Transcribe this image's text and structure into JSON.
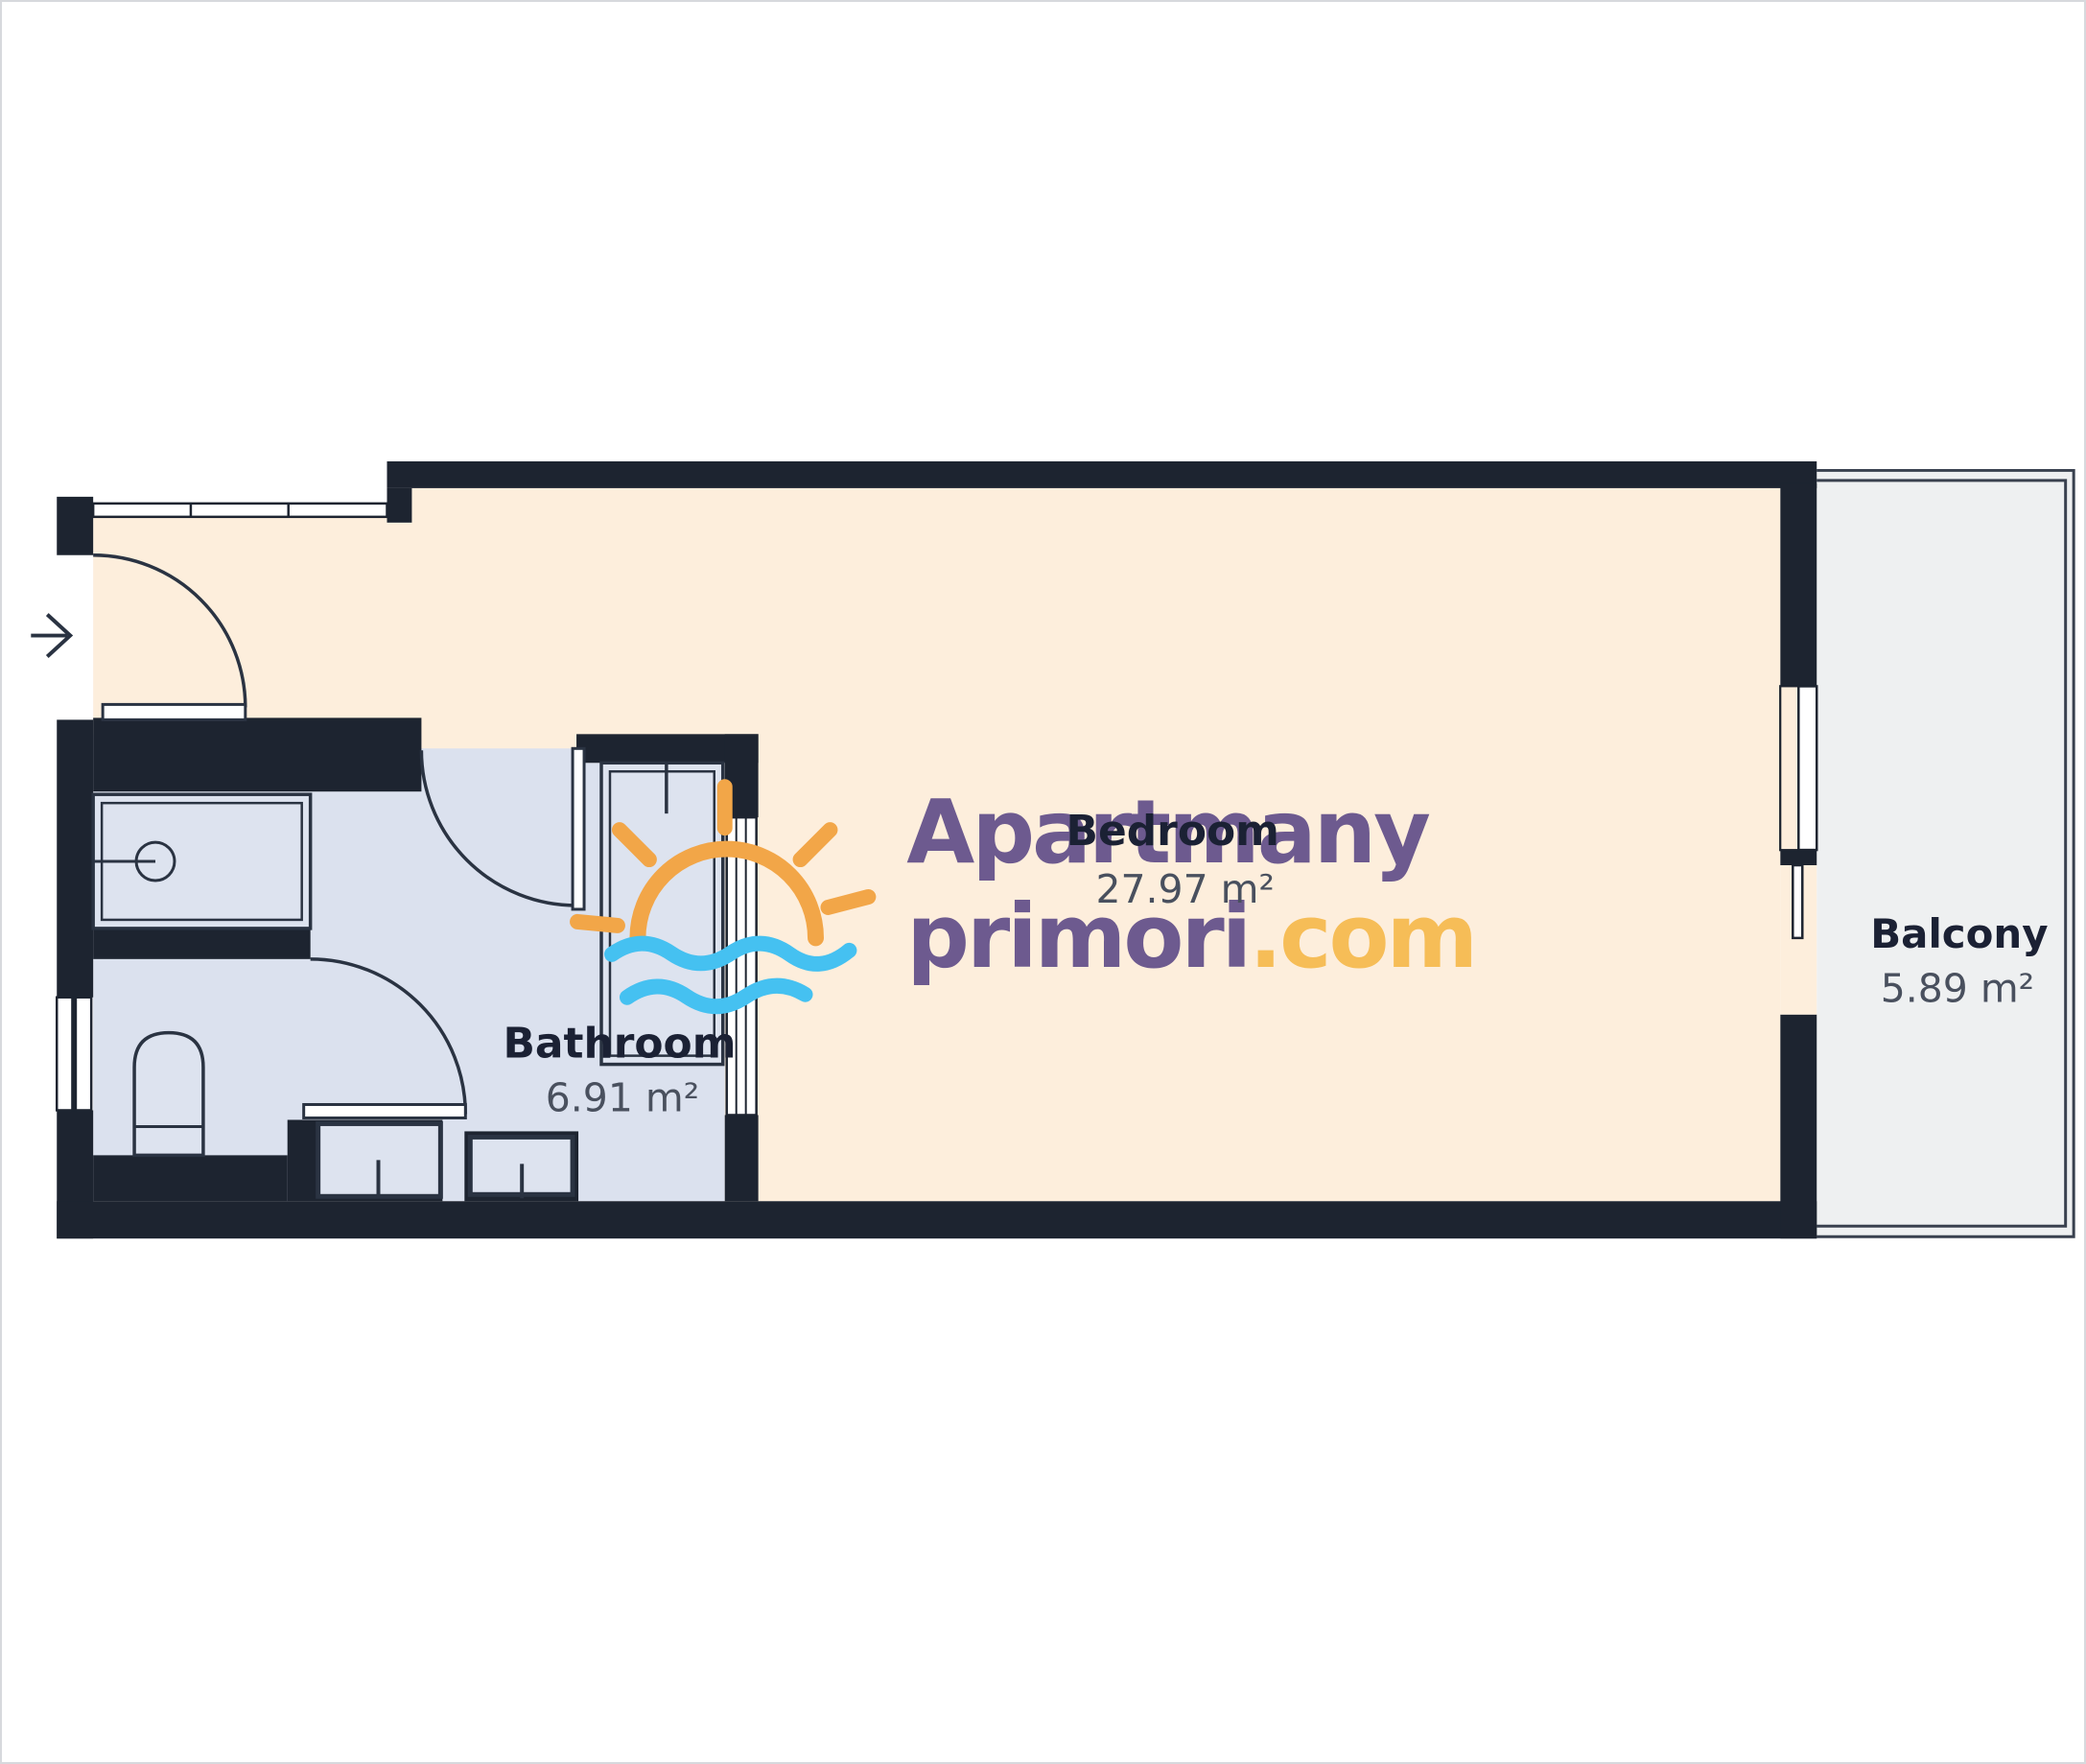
{
  "plan": {
    "type": "apartment-floor-plan"
  },
  "rooms": [
    {
      "id": "bedroom",
      "name": "Bedroom",
      "area": "27.97 m²"
    },
    {
      "id": "bathroom",
      "name": "Bathroom",
      "area": "6.91 m²"
    },
    {
      "id": "balcony",
      "name": "Balcony",
      "area": "5.89 m²"
    }
  ],
  "watermark": {
    "line1": "Apartmany",
    "line2_main": "primori",
    "line2_suffix": ".com",
    "icon": "sun-over-sea-icon"
  },
  "colors": {
    "wall": "#1d2430",
    "outline": "#2a3342",
    "bedroom_floor": "#fdeedc",
    "bathroom_floor": "#dbe1ee",
    "fixture_fill": "#dde3ef",
    "balcony_floor": "#eef0f1",
    "balcony_line": "#39414f",
    "white": "#ffffff",
    "room_name_text": "#1b2134",
    "room_area_text": "#49505e",
    "logo_purple": "#6d5a8f",
    "logo_orange": "#f2a648",
    "logo_yellow": "#f6bd57",
    "logo_blue": "#45c1f1"
  }
}
